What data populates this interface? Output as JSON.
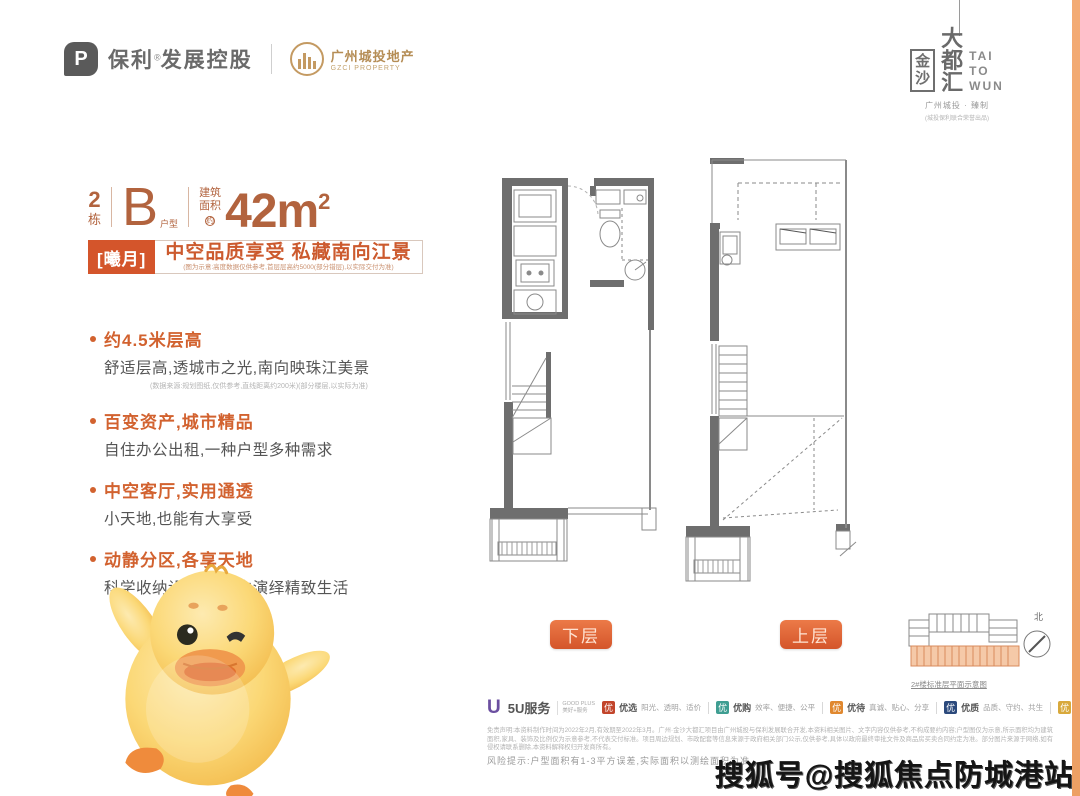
{
  "colors": {
    "accent_orange": "#d4552b",
    "terracotta_text": "#b2633e",
    "feature_orange": "#d2622f",
    "wall_gray": "#6e6e6e",
    "edge_strip": "#eda064",
    "gold_brand": "#b58d55"
  },
  "header": {
    "poly_name": "保利",
    "poly_reg": "®",
    "poly_suffix": "发展控股",
    "gzci_cn": "广州城投地产",
    "gzci_en": "GZCI PROPERTY"
  },
  "brand": {
    "jinsha": [
      "金",
      "沙"
    ],
    "dadu": [
      "大",
      "都",
      "汇"
    ],
    "latin": [
      "TAI",
      "TO",
      "WUN"
    ],
    "credit": "广州城投 · 臻制",
    "credit_sub": "(城投保利联合荣誉出品)"
  },
  "unit": {
    "block_num": "2",
    "block_label": "栋",
    "type_letter": "B",
    "type_label": "户型",
    "area_line1": "建筑",
    "area_line2": "面积",
    "area_about": "约",
    "area_value": "42m",
    "area_sup": "2"
  },
  "headline": {
    "tag": "[曦月]",
    "title": "中空品质享受 私藏南向江景",
    "note": "(图为示意:高度数据仅供参考,首层层高约5000(部分错层),以实际交付为准)"
  },
  "features": [
    {
      "title": "约4.5米层高",
      "desc": "舒适层高,透城市之光,南向映珠江美景",
      "note": "(数据来源:规划图纸,仅供参考,直线距离约200米)(部分楼层,以实际为准)"
    },
    {
      "title": "百变资产,城市精品",
      "desc": "自住办公出租,一种户型多种需求",
      "note": ""
    },
    {
      "title": "中空客厅,实用通透",
      "desc": "小天地,也能有大享受",
      "note": ""
    },
    {
      "title": "动静分区,各享天地",
      "desc": "科学收纳设计,细节中演绎精致生活",
      "note": ""
    }
  ],
  "plans": {
    "lower_label": "下层",
    "upper_label": "上层",
    "north_label": "北",
    "keyplan_caption": "2#楼标准层平面示意图"
  },
  "services": {
    "logo_u": "U",
    "name": "5U服务",
    "sub_line1": "GOOD PLUS",
    "sub_line2": "美好+服务",
    "items": [
      {
        "char": "优",
        "name": "优选",
        "desc": "阳光、透明、适价",
        "style": "background:#c2452c"
      },
      {
        "char": "优",
        "name": "优购",
        "desc": "效率、便捷、公平",
        "style": "background:#3f9e92"
      },
      {
        "char": "优",
        "name": "优待",
        "desc": "真诚、贴心、分享",
        "style": "background:#e0882f"
      },
      {
        "char": "优",
        "name": "优质",
        "desc": "品质、守约、共生",
        "style": "background:#2c4a7c"
      },
      {
        "char": "优",
        "name": "优惠",
        "desc": "周到、惊喜、尊享",
        "style": "background:#d8a93c"
      }
    ]
  },
  "disclaimer": {
    "text": "免责声明:本资料制作时间为2022年2月,有效期至2022年3月。广州·金沙大都汇项目由广州城投与保利发展联合开发,本资料相关图片、文字内容仅供参考,不构成要约内容;户型图仅为示意,所示面积均为建筑面积,家具、装饰及比例仅为示意参考,不代表交付标准。项目周边规划、市政配套等信息来源于政府相关部门公示,仅供参考,具体以政府最终审批文件及商品房买卖合同约定为准。部分图片来源于网络,如有侵权请联系删除,本资料解释权归开发商所有。"
  },
  "risk": "风险提示:户型面积有1-3平方误差,实际面积以测绘面积为准",
  "watermark": "搜狐号@搜狐焦点防城港站"
}
